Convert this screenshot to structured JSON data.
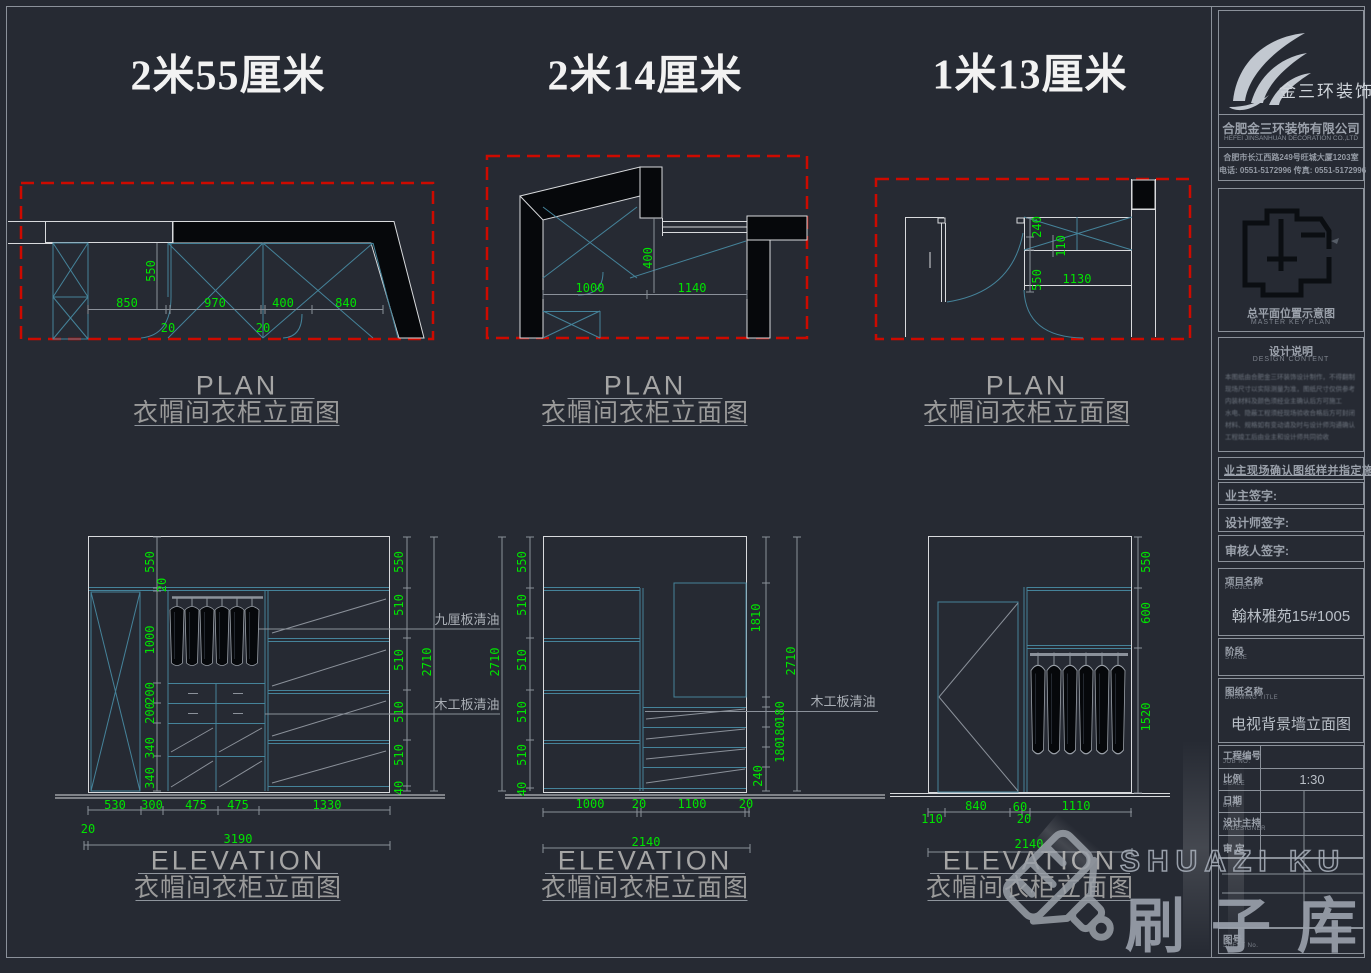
{
  "sections": [
    {
      "header": "2米55厘米"
    },
    {
      "header": "2米14厘米"
    },
    {
      "header": "1米13厘米"
    }
  ],
  "view_titles": {
    "plan_en": "PLAN",
    "plan_zh": "衣帽间衣柜立面图",
    "elev_en": "ELEVATION",
    "elev_zh": "衣帽间衣柜立面图"
  },
  "annotations": {
    "nine_mm_board": "九厘板清油",
    "wood_board": "木工板清油",
    "wood_board_right": "木工板清油"
  },
  "dims": {
    "plan1": [
      "550",
      "850",
      "970",
      "400",
      "840",
      "20",
      "20"
    ],
    "plan2": [
      "400",
      "1000",
      "1140"
    ],
    "plan3": [
      "240",
      "110",
      "550",
      "1130"
    ],
    "elev1_left": [
      "550",
      "20",
      "1000",
      "200",
      "200",
      "340",
      "340"
    ],
    "elev1_right": [
      "550",
      "510",
      "510",
      "510",
      "510",
      "40"
    ],
    "elev1_height": "2710",
    "elev1_bottom": [
      "530",
      "300",
      "475",
      "475",
      "1330"
    ],
    "elev1_gap": "20",
    "elev1_width": "3190",
    "elev2_height_left": "2710",
    "elev2_left": [
      "550",
      "510",
      "510",
      "510",
      "510",
      "40"
    ],
    "elev2_right": [
      "1810",
      "180",
      "180",
      "180",
      "240"
    ],
    "elev2_height_right": "2710",
    "elev2_bottom": [
      "1000",
      "20",
      "1100",
      "20"
    ],
    "elev2_width": "2140",
    "elev3_right": [
      "550",
      "600",
      "1520"
    ],
    "elev3_bottom": [
      "840",
      "60",
      "1110"
    ],
    "elev3_bottom_lower": [
      "110",
      "20"
    ],
    "elev3_width": "2140"
  },
  "titleblock": {
    "brand": "金三环装饰",
    "company_cn": "合肥金三环装饰有限公司",
    "company_en": "HEFEI JINSANHUAN DECORATION CO.,LTD",
    "address": "合肥市长江西路249号旺城大厦1203室",
    "phone_fax": "电话: 0551-5172996    传真: 0551-5172996",
    "keyplan_cn": "总平面位置示意图",
    "keyplan_en": "MASTER KEY PLAN",
    "design_cn": "设计说明",
    "design_en": "DESIGN CONTENT",
    "notes": [
      "本图纸由合肥金三环装饰设计制作，不得翻制",
      "现场尺寸以实际测量为准，图纸尺寸仅供参考",
      "内装材料及颜色须经业主确认后方可施工",
      "水电、隐蔽工程须经现场验收合格后方可封闭",
      "材料、规格如有变动请及时与设计师沟通确认",
      "工程竣工后由业主和设计师共同验收"
    ],
    "confirm": "业主现场确认图纸样并指定施工",
    "sign_owner": "业主签字:",
    "sign_designer": "设计师签字:",
    "sign_auditor": "审核人签字:",
    "project_label_cn": "项目名称",
    "project_label_en": "PROJECT",
    "project_value": "翰林雅苑15#1005",
    "stage_label_cn": "阶段",
    "stage_label_en": "STAGE",
    "drawing_label_cn": "图纸名称",
    "drawing_label_en": "DRAWING TITLE",
    "drawing_value": "电视背景墙立面图",
    "job_label_cn": "工程编号",
    "job_label_en": "JOB NO.",
    "scale_label_cn": "比例",
    "scale_label_en": "SCALE",
    "scale_value": "1:30",
    "date_label_cn": "日期",
    "date_label_en": "DATE",
    "mdesigner_label_cn": "设计主持",
    "mdesigner_label_en": "M.DESIGNER",
    "audit_label_cn": "审 定",
    "sheet_label_cn": "图号",
    "sheet_label_en": "SHEET No."
  },
  "watermark": {
    "text_en": "SHUAZI KU",
    "text_zh": "刷子库"
  },
  "colors": {
    "background": "#262a33",
    "dim_green": "#00e400",
    "line_cyan": "#45839a",
    "line_white": "#d8dadd",
    "red_dashed": "#cd0a00",
    "frame_gray": "#8b919a"
  }
}
